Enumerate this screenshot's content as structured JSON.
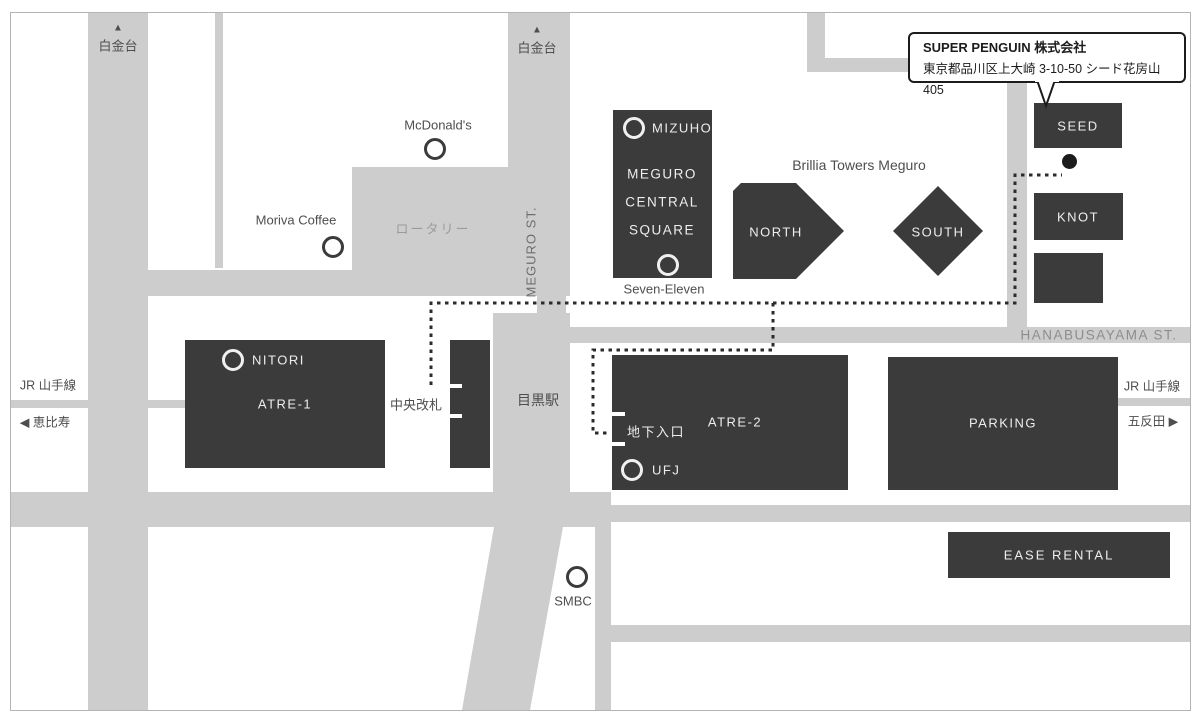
{
  "callout": {
    "company": "SUPER PENGUIN 株式会社",
    "address": "東京都品川区上大崎 3-10-50 シード花房山 405"
  },
  "roads": {
    "up_arrow": "▲",
    "shirokanedai": "白金台",
    "meguro_st": "MEGURO ST.",
    "hanabusayama_st": "HANABUSAYAMA ST.",
    "rotary": "ロータリー",
    "jr_yamanote": "JR 山手線",
    "to_ebisu": "◀ 恵比寿",
    "to_gotanda": "五反田 ▶"
  },
  "station": {
    "meguro_station": "目黒駅",
    "central_gate": "中央改札",
    "underground_entrance": "地下入口"
  },
  "buildings": {
    "mcs_line1": "MEGURO",
    "mcs_line2": "CENTRAL",
    "mcs_line3": "SQUARE",
    "brillia": "Brillia Towers Meguro",
    "north": "NORTH",
    "south": "SOUTH",
    "seed": "SEED",
    "knot": "KNOT",
    "atre1": "ATRE-1",
    "atre2": "ATRE-2",
    "parking": "PARKING",
    "ease_rental": "EASE RENTAL"
  },
  "pois": {
    "mcdonalds": "McDonald's",
    "moriva": "Moriva Coffee",
    "mizuho": "MIZUHO",
    "seven_eleven": "Seven-Eleven",
    "nitori": "NITORI",
    "ufj": "UFJ",
    "smbc": "SMBC"
  },
  "colors": {
    "road_gray": "#cdcdcd",
    "building_dark": "#3b3b3b",
    "route_dash": "#2b2b2b",
    "label_dark": "#4e4e4e",
    "label_on_road": "#9b9b9b",
    "building_text": "#ededed",
    "callout_border": "#1c1c1c"
  }
}
